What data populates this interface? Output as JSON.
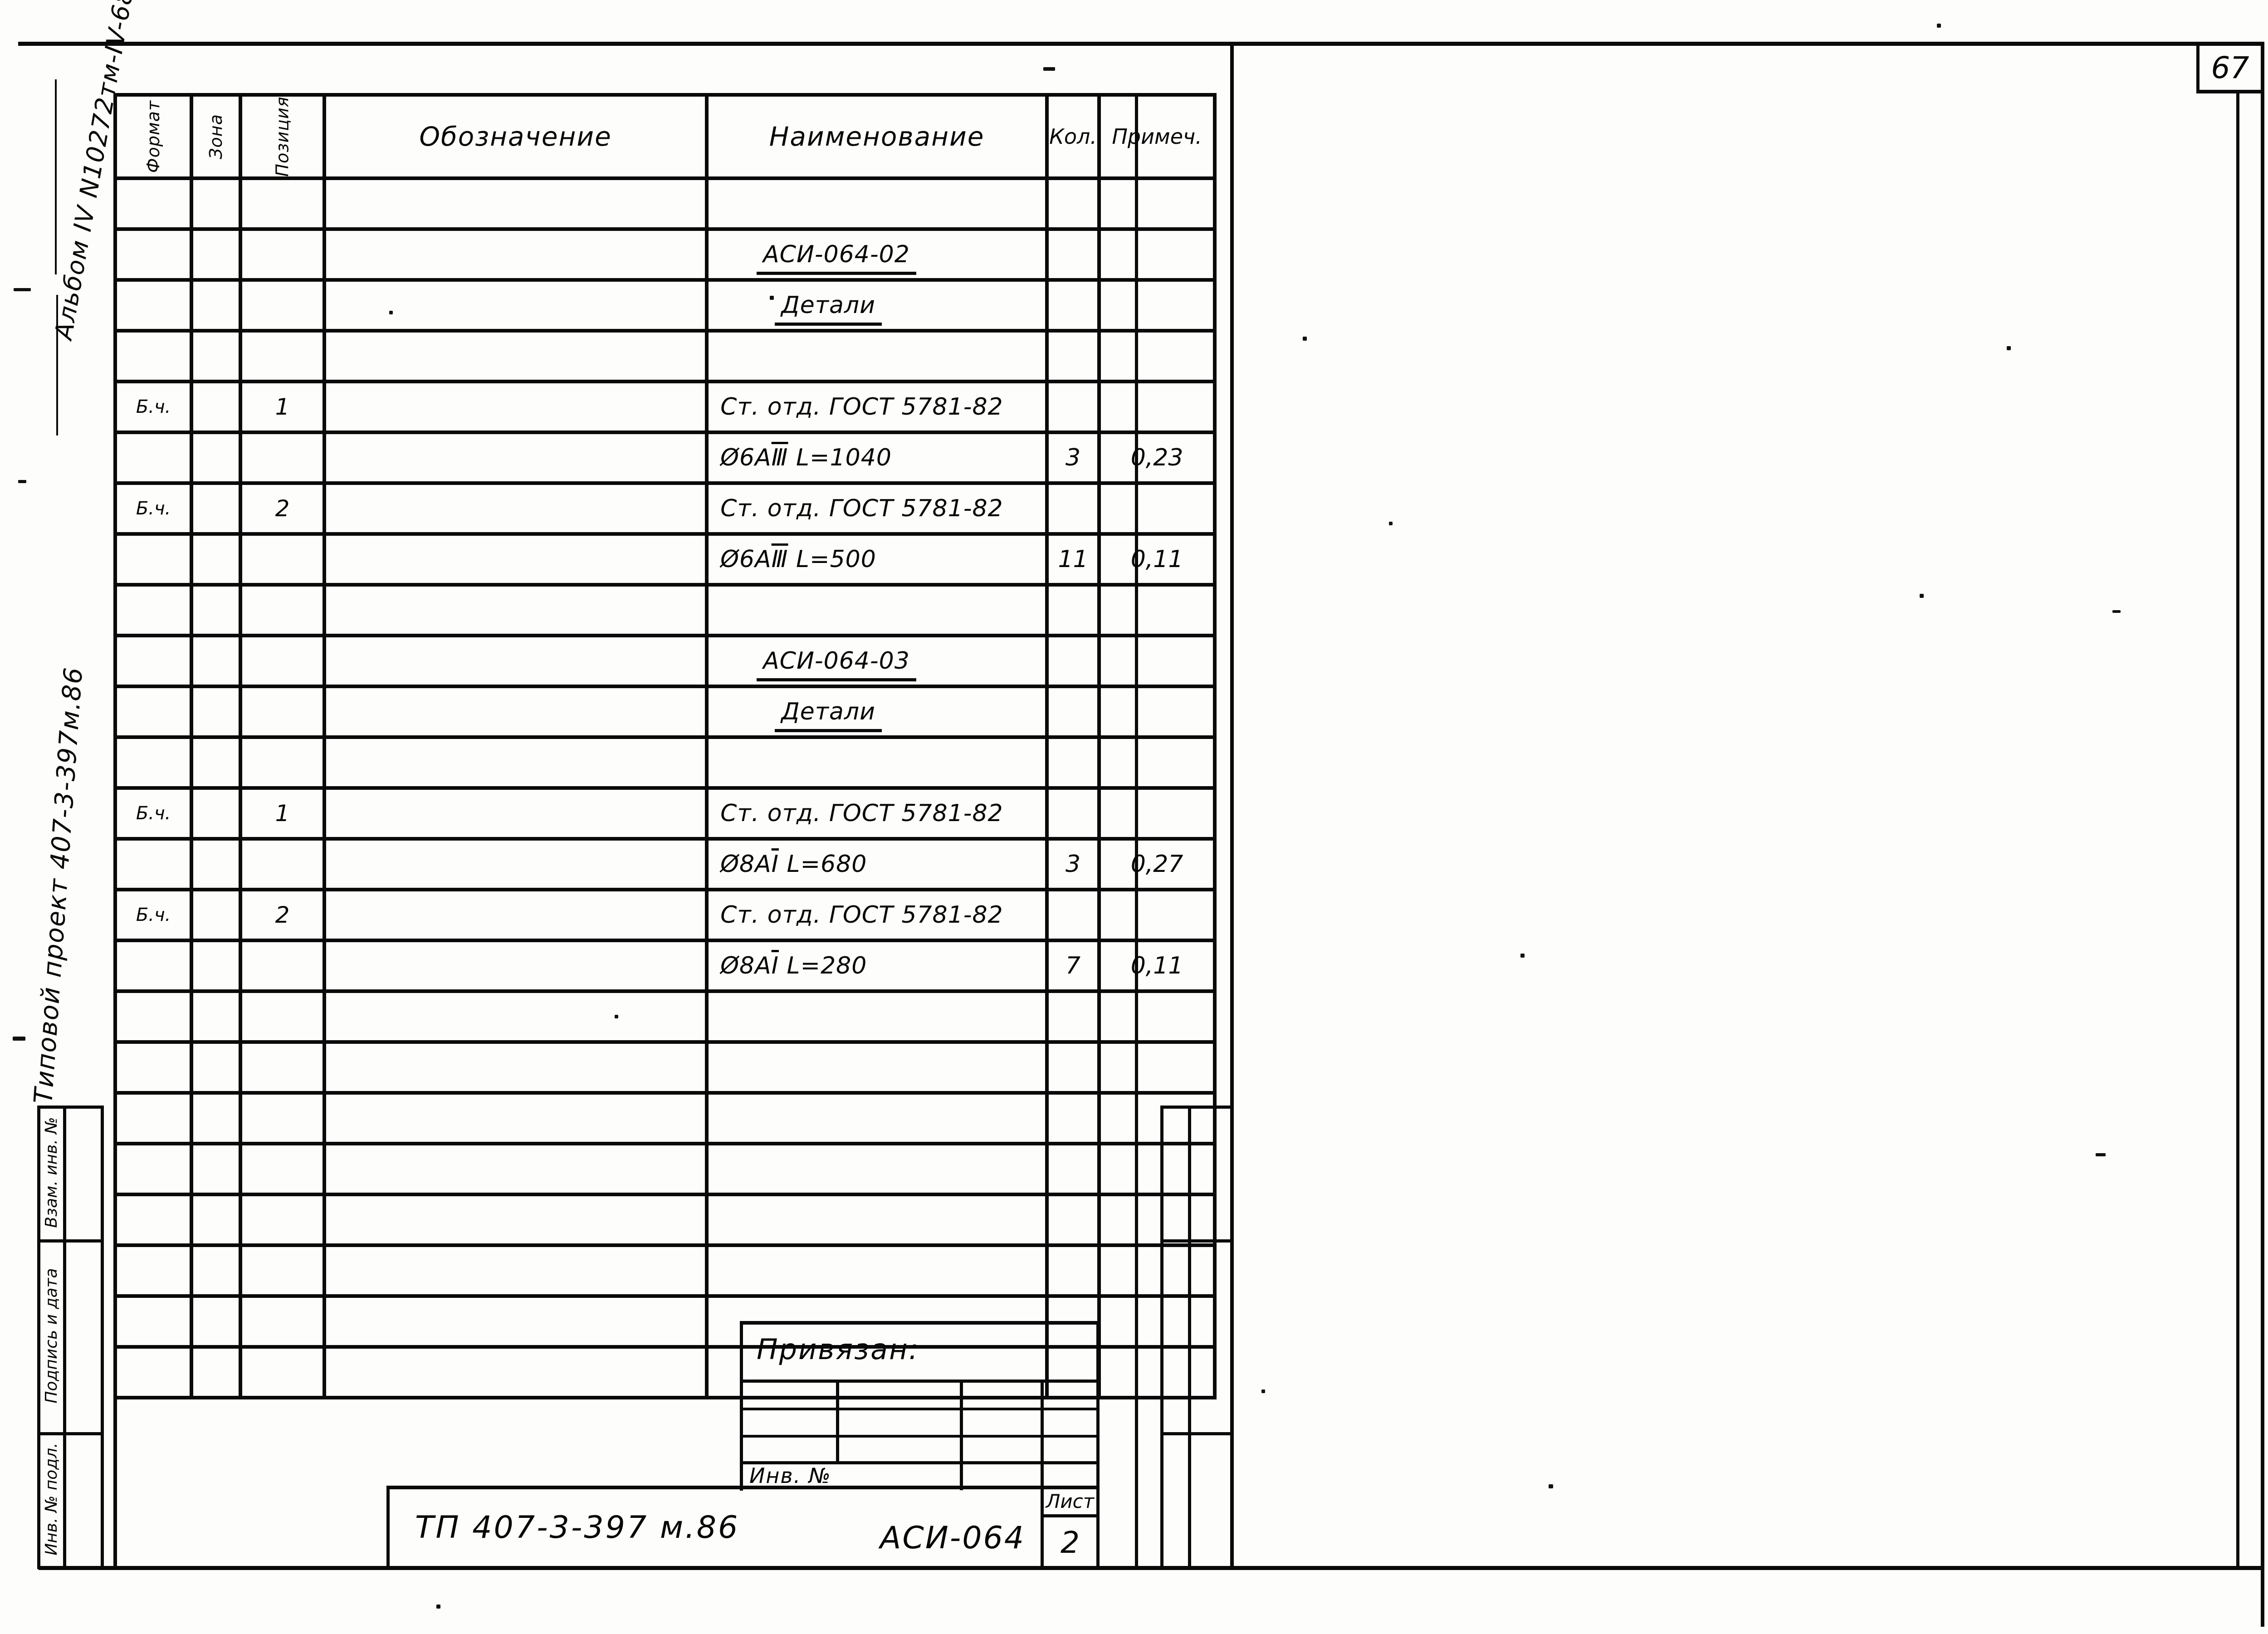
{
  "page": {
    "number": "67"
  },
  "margin_notes": {
    "album": "Альбом IV  N10272тм-IV-68",
    "project": "Типовой  проект  407-3-397м.86"
  },
  "left_stamp": {
    "items": [
      {
        "label": "Взам. инв. №"
      },
      {
        "label": "Подпись и дата"
      },
      {
        "label": "Инв. № подл."
      }
    ]
  },
  "spec_table": {
    "headers": {
      "format": "Формат",
      "zone": "Зона",
      "position": "Позиция",
      "designation": "Обозначение",
      "name": "Наименование",
      "qty": "Кол.",
      "note": "Примеч."
    },
    "rows": [
      {},
      {
        "name": "АСИ-064-02",
        "underline": true,
        "indent": 1
      },
      {
        "name": "Детали",
        "underline": true,
        "indent": 2
      },
      {},
      {
        "format": "Б.ч.",
        "pos": "1",
        "name": "Ст. отд.  ГОСТ 5781-82"
      },
      {
        "name_parts": [
          {
            "t": "Ø6АⅢ",
            "ov_last": true
          },
          {
            "t": "  L=1040"
          }
        ],
        "qty": "3",
        "note": "0,23"
      },
      {
        "format": "Б.ч.",
        "pos": "2",
        "name": "Ст. отд.  ГОСТ 5781-82"
      },
      {
        "name_parts": [
          {
            "t": "Ø6АⅢ",
            "ov_last": true
          },
          {
            "t": "  L=500"
          }
        ],
        "qty": "11",
        "note": "0,11"
      },
      {},
      {
        "name": "АСИ-064-03",
        "underline": true,
        "indent": 1
      },
      {
        "name": "Детали",
        "underline": true,
        "indent": 2
      },
      {},
      {
        "format": "Б.ч.",
        "pos": "1",
        "name": "Ст. отд.  ГОСТ 5781-82"
      },
      {
        "name_parts": [
          {
            "t": "Ø8АⅠ",
            "ov_last": true
          },
          {
            "t": "  L=680"
          }
        ],
        "qty": "3",
        "note": "0,27"
      },
      {
        "format": "Б.ч.",
        "pos": "2",
        "name": "Ст. отд.  ГОСТ 5781-82"
      },
      {
        "name_parts": [
          {
            "t": "Ø8АⅠ",
            "ov_last": true
          },
          {
            "t": "  L=280"
          }
        ],
        "qty": "7",
        "note": "0,11"
      },
      {},
      {},
      {},
      {},
      {},
      {},
      {},
      {}
    ]
  },
  "title_block": {
    "bound_label": "Привязан:",
    "inv_label": "Инв. №",
    "doc_number": "ТП  407-3-397 м.86",
    "code": "АСИ-064",
    "sheet_label": "Лист",
    "sheet_number": "2"
  }
}
